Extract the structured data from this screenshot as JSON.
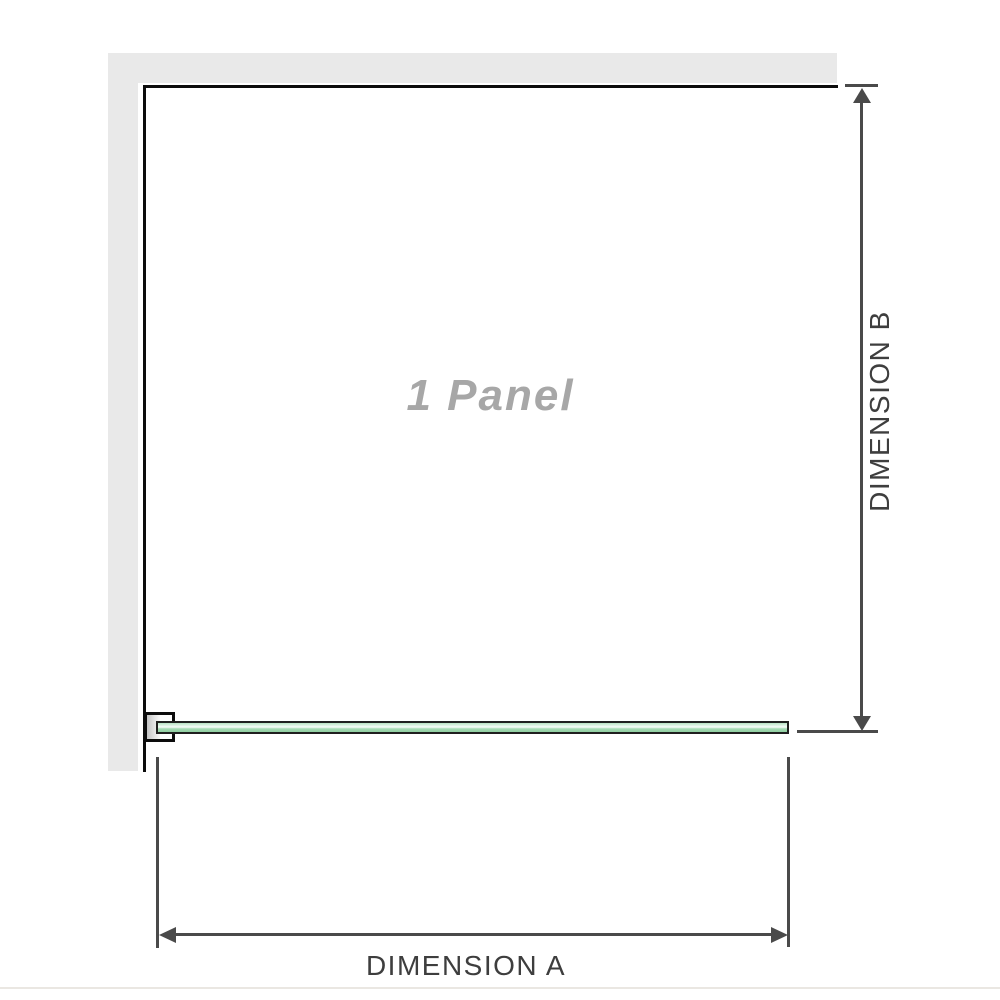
{
  "diagram": {
    "panel_label": "1 Panel",
    "dimension_a": {
      "label": "DIMENSION A"
    },
    "dimension_b": {
      "label": "DIMENSION B"
    },
    "colors": {
      "wall_gray": "#e9e9e9",
      "outline_black": "#0c0c0c",
      "dimension_gray": "#4a4a4a",
      "label_text": "#3e3e3e",
      "panel_label_gray": "#a7a7a7",
      "glass_green": "#9fd6af",
      "glass_highlight": "#f8fcf9"
    }
  }
}
